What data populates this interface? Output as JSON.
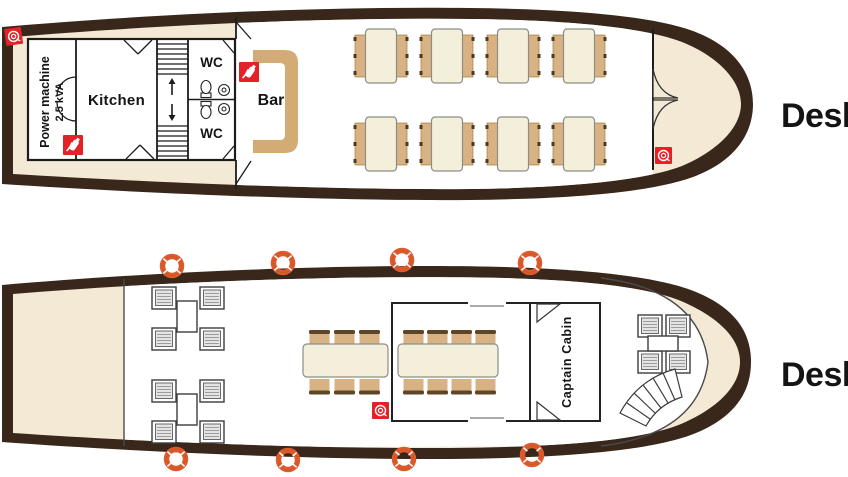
{
  "diagram_title": "Boat deck plan",
  "deck1": {
    "label": "Desk",
    "power_machine": {
      "line1": "Power machine",
      "line2": "2.5 kVA"
    },
    "kitchen": "Kitchen",
    "wc_top": "WC",
    "wc_bottom": "WC",
    "bar": "Bar",
    "tables_for_four": 8,
    "icons": [
      "fire-hose-reel",
      "fire-extinguisher",
      "fire-extinguisher",
      "fire-hose-reel"
    ]
  },
  "deck2": {
    "label": "Desk",
    "captain_cabin": "Captain Cabin",
    "long_tables": 2,
    "lounge_groups": 3,
    "life_buoys": 8,
    "icons": [
      "fire-hose-reel"
    ]
  },
  "colors": {
    "hull": "#38271a",
    "deck_beige": "#f3e9d4",
    "interior_white": "#ffffff",
    "bar_wood": "#d3ab74",
    "chair_tan": "#d9b283",
    "table_cream": "#f3efdb",
    "safety_red": "#e32127",
    "buoy_orange": "#dd5a2c",
    "wall_line": "#1c1c1c"
  }
}
